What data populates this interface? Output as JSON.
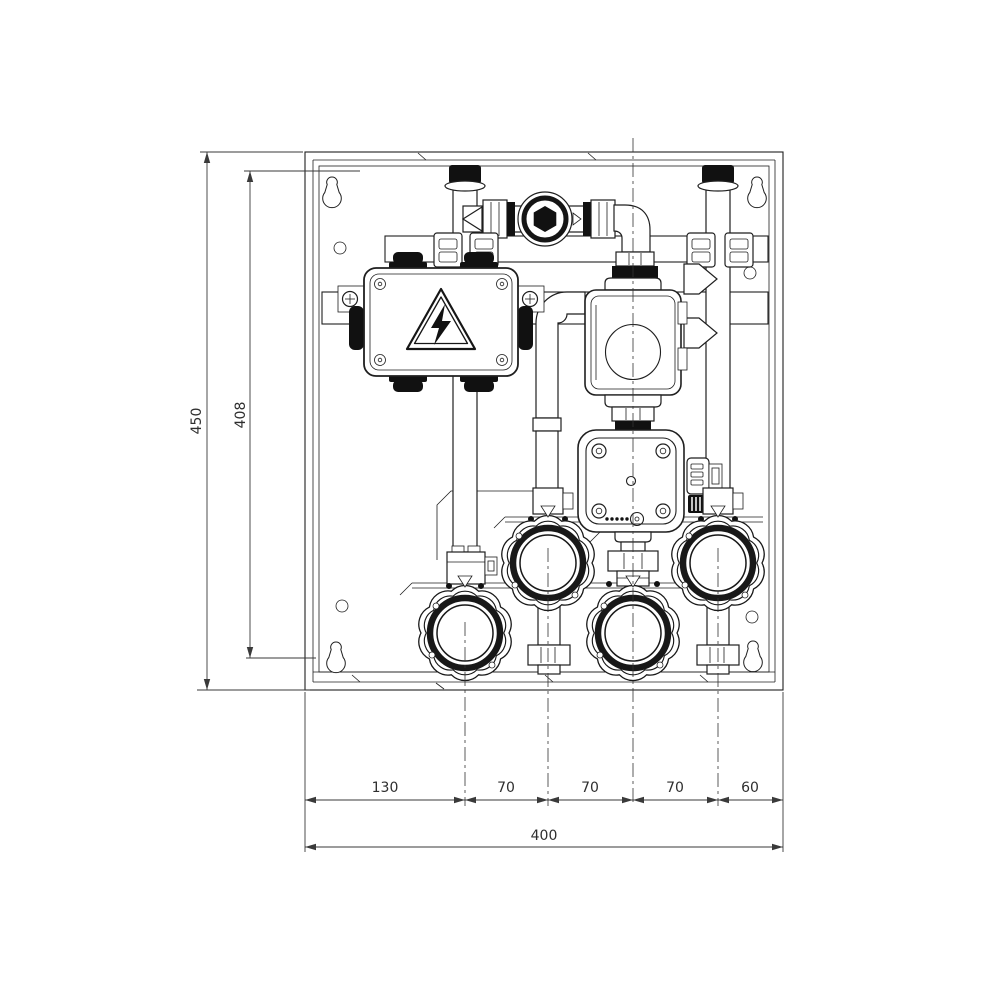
{
  "drawing": {
    "type": "technical-installation-drawing",
    "subject": "wall-mounted hydraulic pump group module",
    "units": "mm",
    "dim_overall_height": "450",
    "dim_panel_height": "408",
    "dim_overall_width": "400",
    "dim_segments": [
      "130",
      "70",
      "70",
      "70",
      "60"
    ],
    "colors": {
      "line": "#1f1f1f",
      "dimension": "#3a3a3a",
      "solid_fill": "#111111",
      "background": "#ffffff"
    },
    "components": [
      "wall-cabinet",
      "back-panel",
      "mounting-keyholes",
      "junction-box",
      "high-voltage-warning-triangle",
      "upper-circulation-pump",
      "lower-circulation-pump",
      "check-valve-sight-glass",
      "pipe-elbow",
      "ball-valve-knob-1",
      "ball-valve-knob-2",
      "ball-valve-knob-3",
      "ball-valve-knob-4",
      "union-nuts",
      "flow-direction-arrows",
      "mounting-rails",
      "cable-glands"
    ]
  }
}
